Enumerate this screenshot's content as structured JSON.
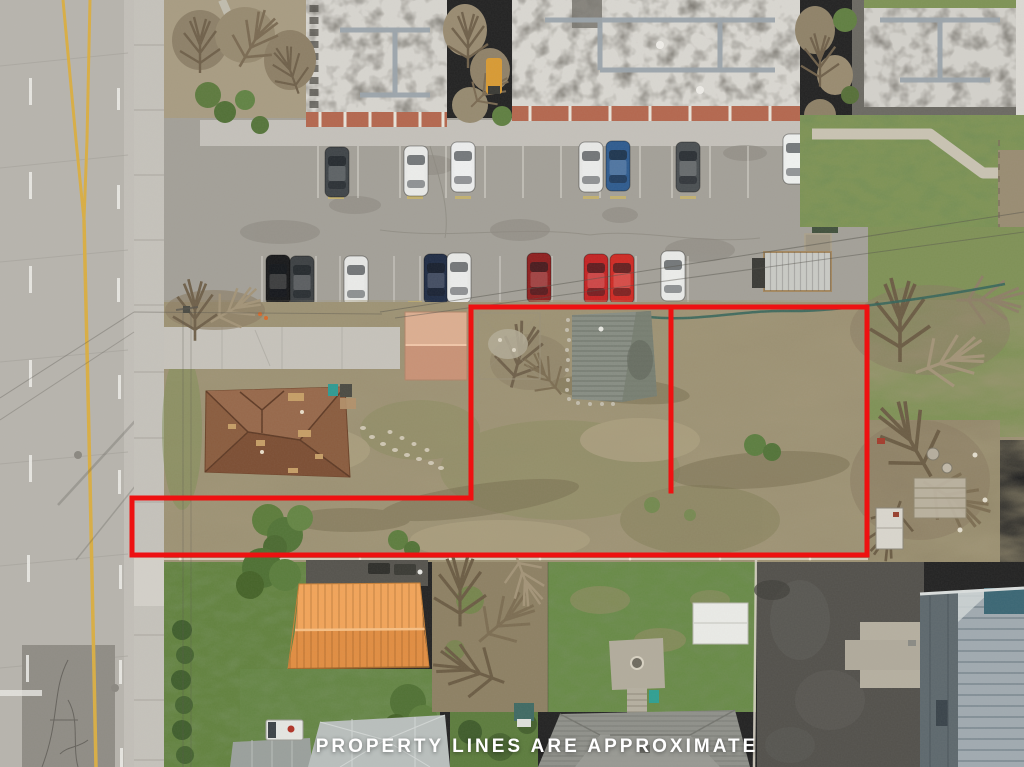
{
  "meta": {
    "description": "Aerial drone listing photo of vacant land parcels beside a road",
    "width": 1024,
    "height": 767
  },
  "caption": {
    "text": "PROPERTY LINES ARE APPROXIMATE",
    "color": "#ffffff"
  },
  "property_lines": {
    "color": "#ee1111",
    "stroke_width": "5",
    "outer_points": "471,307 867,307 867,555 132,555 132,498 471,498",
    "divider_points": "671,307 671,491"
  },
  "palette": {
    "road": "#b7b4ad",
    "center_line_yellow": "#d9ae44",
    "parking_asphalt": "#a3a098",
    "field_tan": "#9c9173",
    "grass_green": "#6b8c49",
    "house_roof_brown": "#8a5c3e",
    "shed_roof_salmon": "#d2a084",
    "outbuilding_roof_orange": "#ef9f52",
    "apartment_roof_white": "#d8d6d0",
    "warehouse_roof_gray": "#a0aab0",
    "dark_asphalt": "#52504b"
  }
}
